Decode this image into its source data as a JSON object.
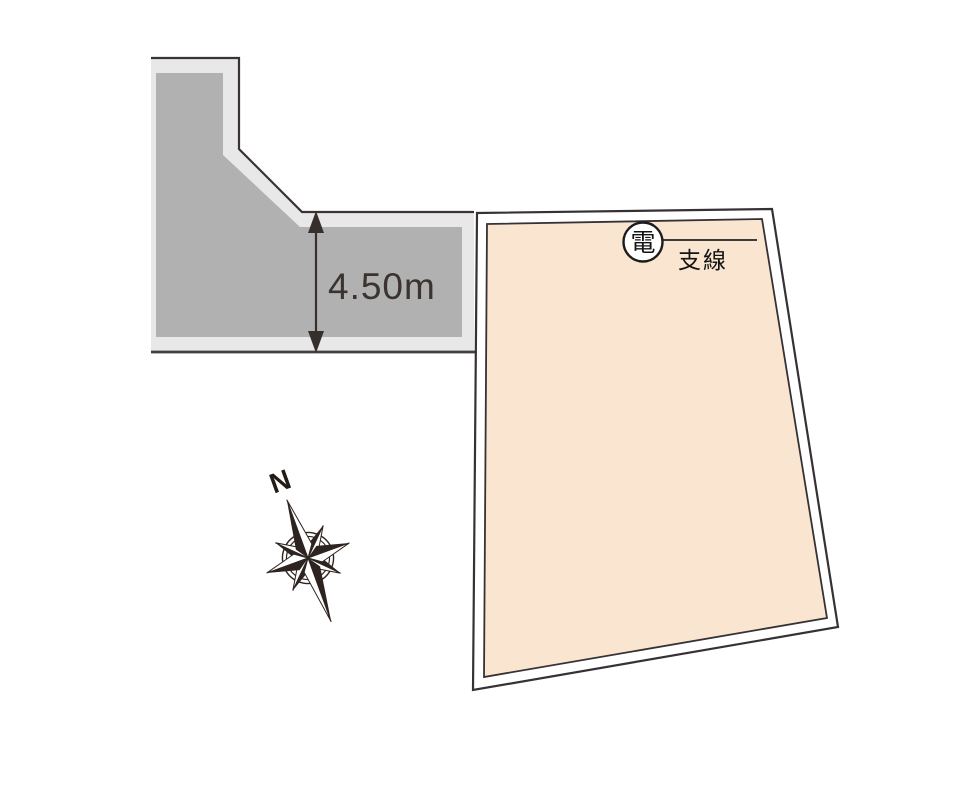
{
  "page": {
    "background": "#ffffff"
  },
  "colors": {
    "road_shoulder": "#e8e8e9",
    "road_surface": "#b1b1b2",
    "outline": "#3a3233",
    "plot_fill": "#fae6d0",
    "plot_outline": "#363134",
    "ink": "#141414",
    "dimension": "#362f2c",
    "compass": "#241b15"
  },
  "plan": {
    "road": {
      "width_label": "4.50m"
    },
    "plot": {
      "pole_label": "電",
      "guy_wire_label": "支線"
    },
    "compass": {
      "north_label": "N"
    }
  }
}
